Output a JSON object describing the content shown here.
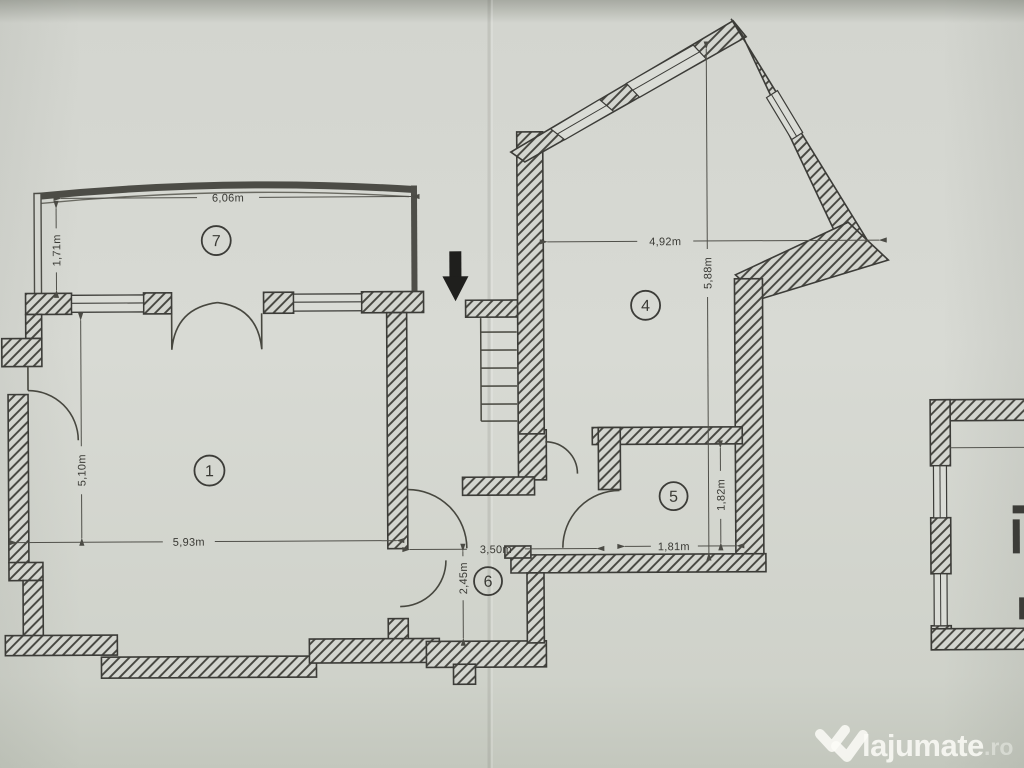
{
  "document": {
    "type": "scanned apartment floor plan photo"
  },
  "rooms": [
    {
      "number": "7",
      "width": "6,06m",
      "depth": "1,71m"
    },
    {
      "number": "1",
      "width": "5,93m",
      "depth": "5,10m"
    },
    {
      "number": "4",
      "width": "4,92m",
      "depth": "5,88m"
    },
    {
      "number": "5",
      "width": "1,81m",
      "depth": "1,82m"
    },
    {
      "number": "6",
      "width": "3,50m",
      "depth": "2,45m"
    }
  ],
  "watermark": {
    "brand": "lajumate",
    "tld": ".ro"
  },
  "colors": {
    "paper": "#d7d9d3",
    "ink": "#3c3c38",
    "watermark": "#fafaf8"
  }
}
